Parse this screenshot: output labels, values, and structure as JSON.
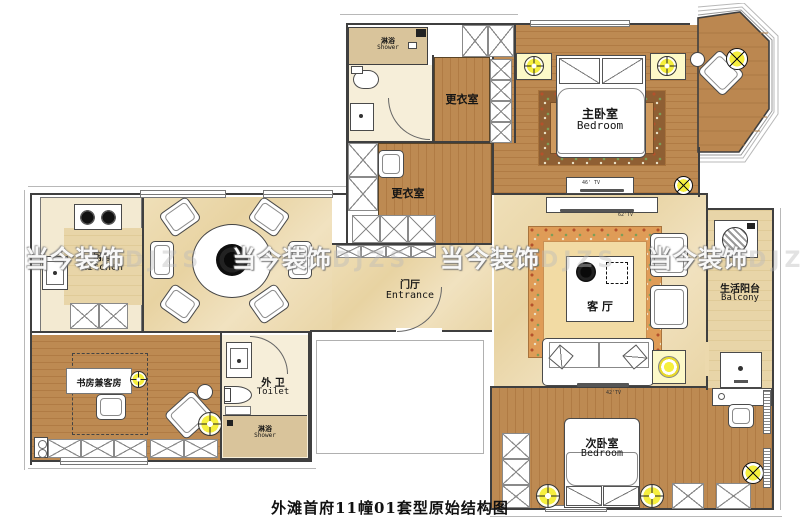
{
  "caption": "外滩首府11幢01套型原始结构图",
  "watermark": {
    "zh": "当今装饰",
    "latin": "DJZS"
  },
  "rooms": {
    "shower_top": {
      "zh": "淋浴",
      "en": "Shower"
    },
    "dressing_upper": {
      "zh": "更衣室"
    },
    "dressing_lower": {
      "zh": "更衣室"
    },
    "master_bedroom": {
      "zh": "主卧室",
      "en": "Bedroom"
    },
    "kitchen": {
      "zh": "厨房",
      "en": "Kitchen"
    },
    "entrance": {
      "zh": "门厅",
      "en": "Entrance"
    },
    "living_room": {
      "zh": "客 厅"
    },
    "balcony": {
      "zh": "生活阳台",
      "en": "Balcony"
    },
    "study": {
      "zh": "书房兼客房"
    },
    "toilet": {
      "zh": "外 卫",
      "en": "Toilet"
    },
    "shower_bottom": {
      "zh": "淋浴",
      "en": "Shower"
    },
    "second_bedroom": {
      "zh": "次卧室",
      "en": "Bedroom"
    }
  },
  "equipment": {
    "tv_master": "46' TV",
    "tv_living": "62'TV",
    "tv_second": "42'TV"
  },
  "colors": {
    "wood": "#bd8a52",
    "marble": "#ecd9ad",
    "pale_floor": "#f6eed9",
    "shower_beige": "#d9c49b",
    "highlight_yellow": "#f6ef3e",
    "wall": "#3f3f3f"
  }
}
